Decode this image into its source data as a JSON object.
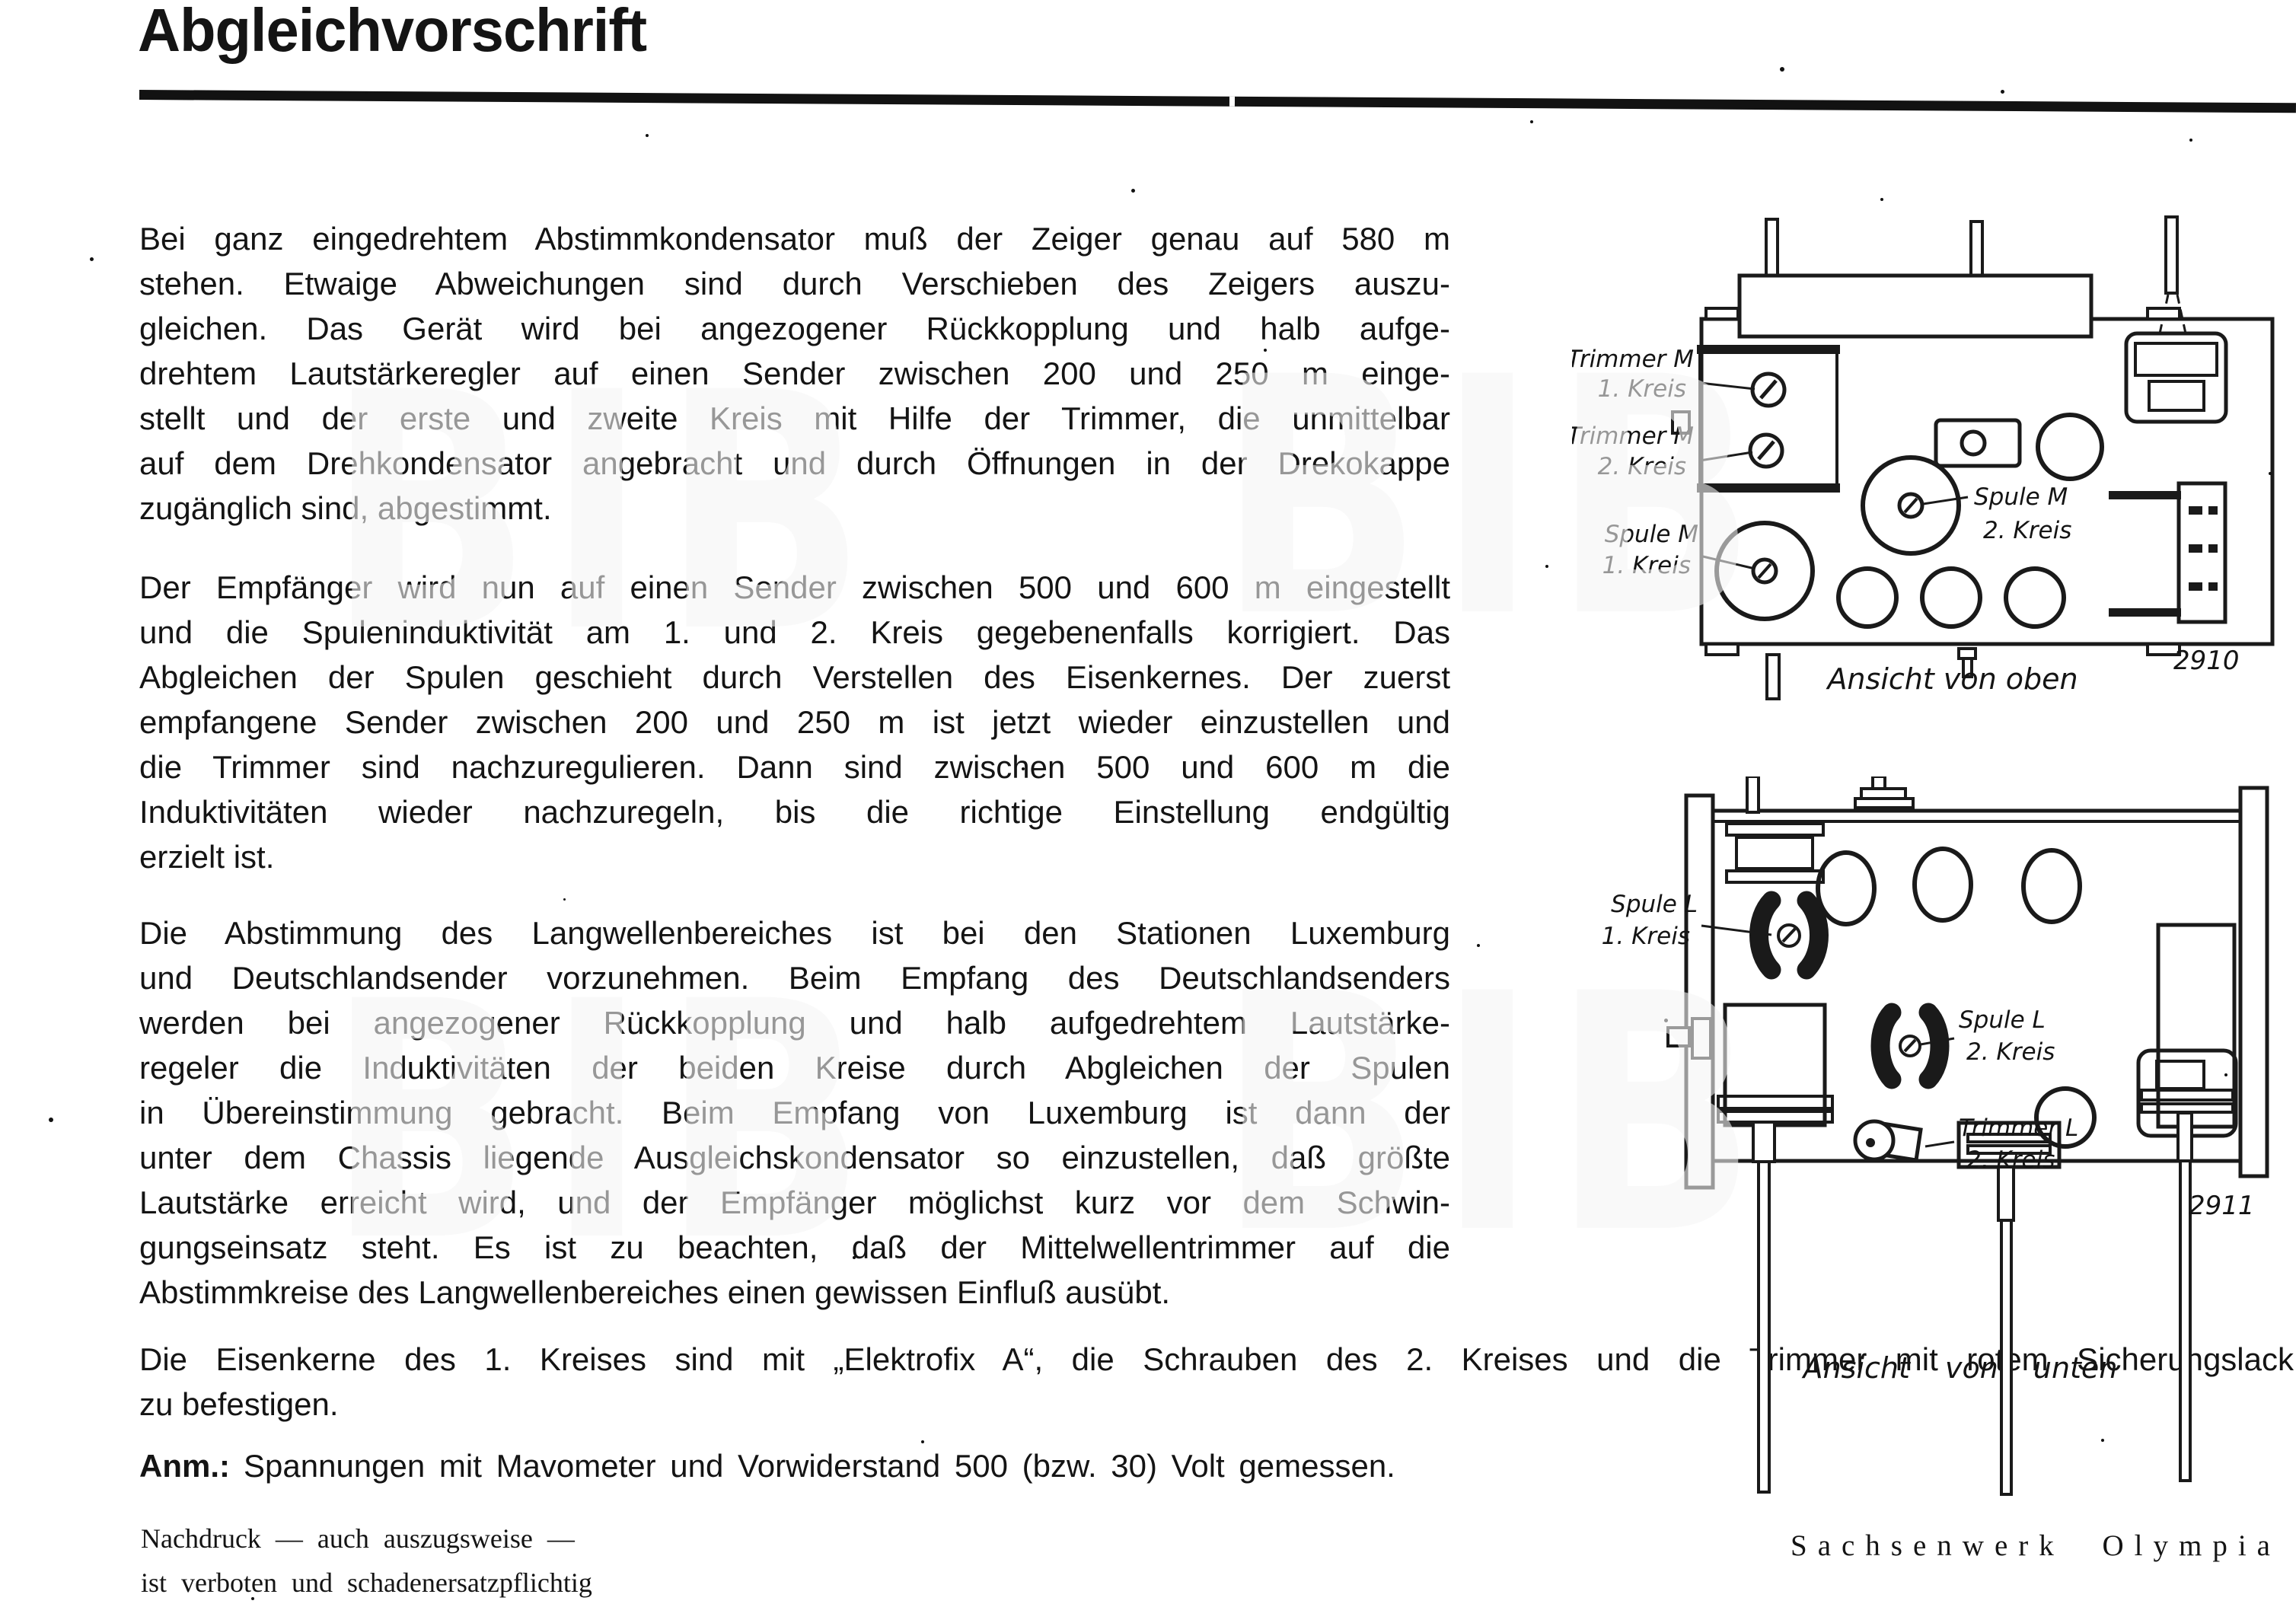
{
  "page": {
    "title": "Abgleichvorschrift",
    "watermark": "BIB",
    "paragraphs": {
      "p1": {
        "lines": [
          "Bei ganz eingedrehtem Abstimmkondensator muß der Zeiger genau auf 580 m",
          "stehen.  Etwaige Abweichungen sind durch Verschieben des Zeigers auszu-",
          "gleichen.  Das Gerät wird bei angezogener Rückkopplung und halb aufge-",
          "drehtem Lautstärkeregler auf einen Sender zwischen 200 und 250 m einge-",
          "stellt und der erste und zweite Kreis mit Hilfe der Trimmer, die unmittelbar",
          "auf dem Drehkondensator angebracht und durch Öffnungen in der Drekokappe",
          "zugänglich sind, abgestimmt."
        ]
      },
      "p2": {
        "lines": [
          "Der Empfänger wird nun auf einen Sender zwischen 500 und 600 m eingestellt",
          "und die Spuleninduktivität am 1. und 2. Kreis gegebenenfalls korrigiert. Das",
          "Abgleichen der Spulen geschieht durch Verstellen des Eisenkernes. Der zuerst",
          "empfangene Sender zwischen 200 und 250 m ist jetzt wieder einzustellen und",
          "die Trimmer sind nachzuregulieren.  Dann sind zwischen 500 und 600 m die",
          "Induktivitäten wieder nachzuregeln, bis die richtige Einstellung endgültig",
          "erzielt ist."
        ]
      },
      "p3": {
        "lines": [
          "Die Abstimmung des Langwellenbereiches ist bei den Stationen Luxemburg",
          "und Deutschlandsender vorzunehmen.  Beim Empfang des Deutschlandsenders",
          "werden bei angezogener Rückkopplung und halb aufgedrehtem Lautstärke-",
          "regeler die Induktivitäten der beiden Kreise durch Abgleichen der Spulen",
          "in Übereinstimmung gebracht.  Beim Empfang von Luxemburg ist dann der",
          "unter dem Chassis liegende Ausgleichskondensator so einzustellen, daß größte",
          "Lautstärke erreicht wird, und der Empfänger möglichst kurz vor dem Schwin-",
          "gungseinsatz steht.  Es ist zu beachten, daß der Mittelwellentrimmer auf die",
          "Abstimmkreise des Langwellenbereiches einen gewissen Einfluß ausübt."
        ]
      },
      "p4": {
        "lines": [
          "Die Eisenkerne des 1. Kreises sind mit „Elektrofix A“, die Schrauben des 2. Kreises und die Trimmer mit rotem Sicherungslack",
          "zu befestigen."
        ]
      },
      "anm": {
        "label": "Anm.:",
        "text": "Spannungen mit Mavometer und Vorwiderstand 500 (bzw. 30) Volt gemessen."
      }
    },
    "footer": {
      "notice_line1": "Nachdruck  —  auch  auszugsweise  —",
      "notice_line2": "ist verboten und schadenersatzpflichtig",
      "model": "Sachsenwerk Olympia 23 W"
    }
  },
  "diagram_top": {
    "caption": "Ansicht von oben",
    "figure_number": "2910",
    "labels": {
      "trimmer_m1": [
        "Trimmer M",
        "1. Kreis"
      ],
      "trimmer_m2": [
        "Trimmer M",
        "2. Kreis"
      ],
      "spule_m2": [
        "Spule M",
        "2. Kreis"
      ],
      "spule_m1": [
        "Spule M",
        "1. Kreis"
      ]
    }
  },
  "diagram_bottom": {
    "caption": "Ansicht von unten",
    "figure_number": "2911",
    "labels": {
      "spule_l1": [
        "Spule L",
        "1. Kreis"
      ],
      "spule_l2": [
        "Spule L",
        "2. Kreis"
      ],
      "trimmer_l2": [
        "Trimmer L",
        "2. Kreis"
      ]
    }
  },
  "colors": {
    "ink": "#141414",
    "paper": "#ffffff",
    "watermark_gray": "#8f8f8f"
  }
}
